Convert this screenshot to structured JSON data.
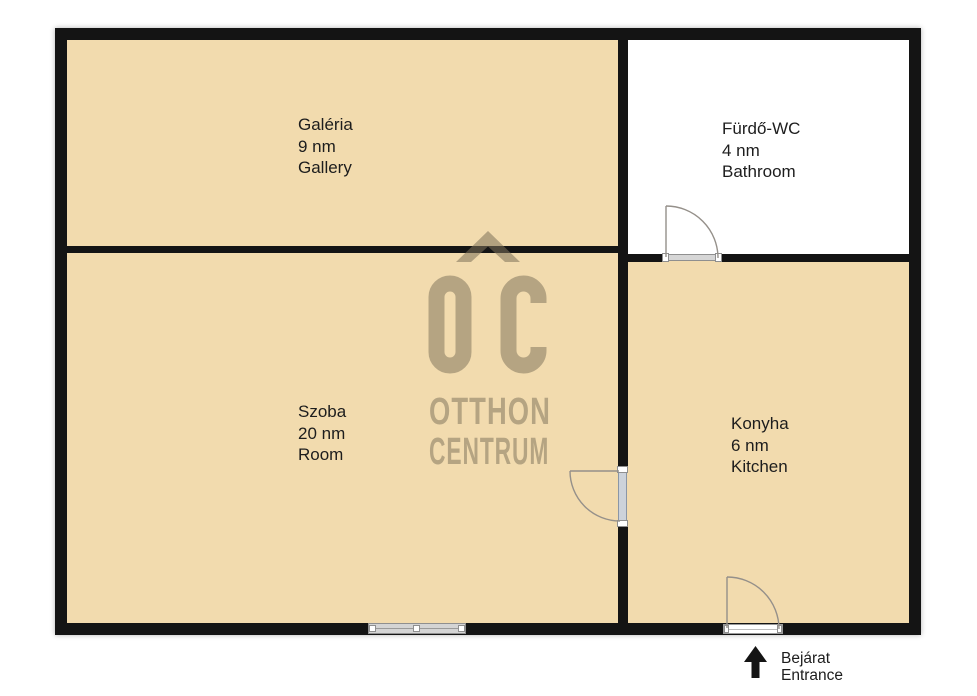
{
  "plan": {
    "rooms": [
      {
        "name_local": "Galéria",
        "area": "9 nm",
        "name_en": "Gallery"
      },
      {
        "name_local": "Fürdő-WC",
        "area": "4 nm",
        "name_en": "Bathroom"
      },
      {
        "name_local": "Szoba",
        "area": "20 nm",
        "name_en": "Room"
      },
      {
        "name_local": "Konyha",
        "area": "6 nm",
        "name_en": "Kitchen"
      }
    ],
    "entrance": {
      "label_local": "Bejárat",
      "label_en": "Entrance"
    },
    "watermark": {
      "monogram": "OC",
      "brand_line1": "OTTHON",
      "brand_line2": "CENTRUM"
    },
    "icons": {
      "entrance_arrow": "up-arrow-into-kitchen-doorway",
      "roof": "house-roof-chevron-logo"
    },
    "colors": {
      "floor_tan": "#F2DBAE",
      "bathroom_white": "#FFFFFF",
      "wall_black": "#141414",
      "watermark": "rgba(125,113,90,0.52)",
      "door_line": "#95908a",
      "label_text": "#1D1D1D"
    }
  }
}
